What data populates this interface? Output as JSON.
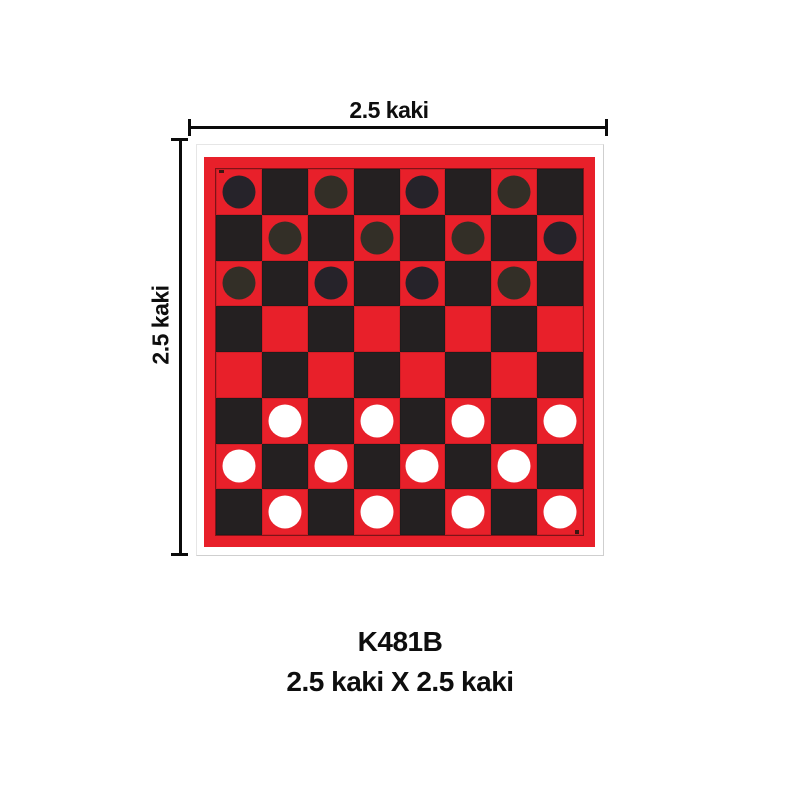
{
  "dimensions": {
    "top_label": "2.5 kaki",
    "left_label": "2.5 kaki"
  },
  "caption": {
    "code": "K481B",
    "size_text": "2.5 kaki X 2.5 kaki"
  },
  "colors": {
    "board_red": "#e8202a",
    "dark_square": "#242021",
    "dark_piece_a": "#26232a",
    "dark_piece_b": "#332f27",
    "white_piece": "#ffffff",
    "dimension_line": "#0b0b0b",
    "card_border": "#cfcfcf"
  },
  "board": {
    "grid_size": 8,
    "cell_legend": {
      "r": {
        "square": "board_red"
      },
      "b": {
        "square": "dark_square"
      },
      "d1": {
        "square": "board_red",
        "piece": "dark_piece_a",
        "piece_name": "dark-checker-piece"
      },
      "d2": {
        "square": "board_red",
        "piece": "dark_piece_b",
        "piece_name": "dark-checker-piece"
      },
      "w": {
        "square": "board_red",
        "piece": "white_piece",
        "piece_name": "white-checker-piece"
      }
    },
    "rows": [
      [
        "d1",
        "b",
        "d2",
        "b",
        "d1",
        "b",
        "d2",
        "b"
      ],
      [
        "b",
        "d2",
        "b",
        "d2",
        "b",
        "d2",
        "b",
        "d1"
      ],
      [
        "d2",
        "b",
        "d1",
        "b",
        "d1",
        "b",
        "d2",
        "b"
      ],
      [
        "b",
        "r",
        "b",
        "r",
        "b",
        "r",
        "b",
        "r"
      ],
      [
        "r",
        "b",
        "r",
        "b",
        "r",
        "b",
        "r",
        "b"
      ],
      [
        "b",
        "w",
        "b",
        "w",
        "b",
        "w",
        "b",
        "w"
      ],
      [
        "w",
        "b",
        "w",
        "b",
        "w",
        "b",
        "w",
        "b"
      ],
      [
        "b",
        "w",
        "b",
        "w",
        "b",
        "w",
        "b",
        "w"
      ]
    ]
  }
}
